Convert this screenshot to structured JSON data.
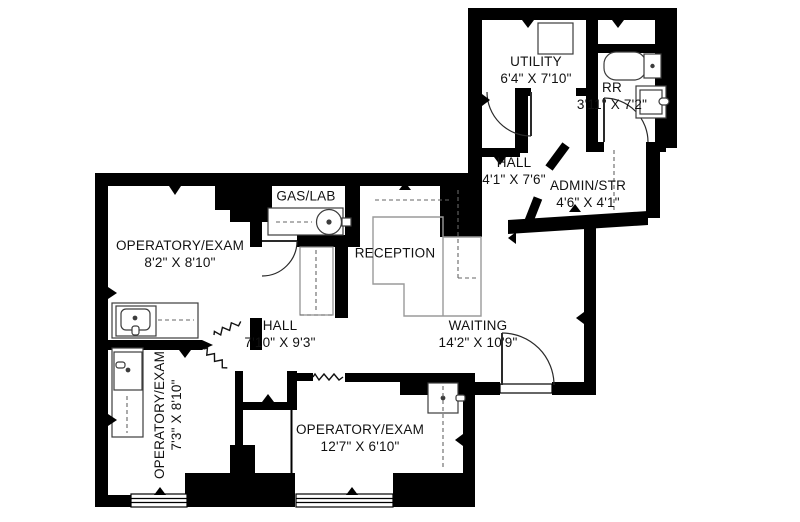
{
  "floor_plan": {
    "type": "dental-office-floor-plan",
    "colors": {
      "walls": "#000000",
      "background": "#ffffff",
      "desk_outline": "#9a9a9a",
      "fixture_outline": "#3c3c3c",
      "dashed_guides": "#666666"
    },
    "rooms": [
      {
        "id": "utility",
        "name": "UTILITY",
        "dims": "6'4\" X 7'10\""
      },
      {
        "id": "restroom",
        "name": "RR",
        "dims": "3'11\" X 7'2\""
      },
      {
        "id": "hall-upper",
        "name": "HALL",
        "dims": "4'1\" X 7'6\""
      },
      {
        "id": "admin-storage",
        "name": "ADMIN/STR",
        "dims": "4'6\" X 4'1\""
      },
      {
        "id": "gas-lab",
        "name": "GAS/LAB",
        "dims": ""
      },
      {
        "id": "operatory-exam-1",
        "name": "OPERATORY/EXAM",
        "dims": "8'2\" X 8'10\""
      },
      {
        "id": "reception",
        "name": "RECEPTION",
        "dims": ""
      },
      {
        "id": "hall-main",
        "name": "HALL",
        "dims": "7'10\" X 9'3\""
      },
      {
        "id": "waiting",
        "name": "WAITING",
        "dims": "14'2\" X 10'9\""
      },
      {
        "id": "operatory-exam-2",
        "name": "OPERATORY/EXAM",
        "dims": "7'3\" X 8'10\""
      },
      {
        "id": "operatory-exam-3",
        "name": "OPERATORY/EXAM",
        "dims": "12'7\" X 6'10\""
      }
    ]
  }
}
